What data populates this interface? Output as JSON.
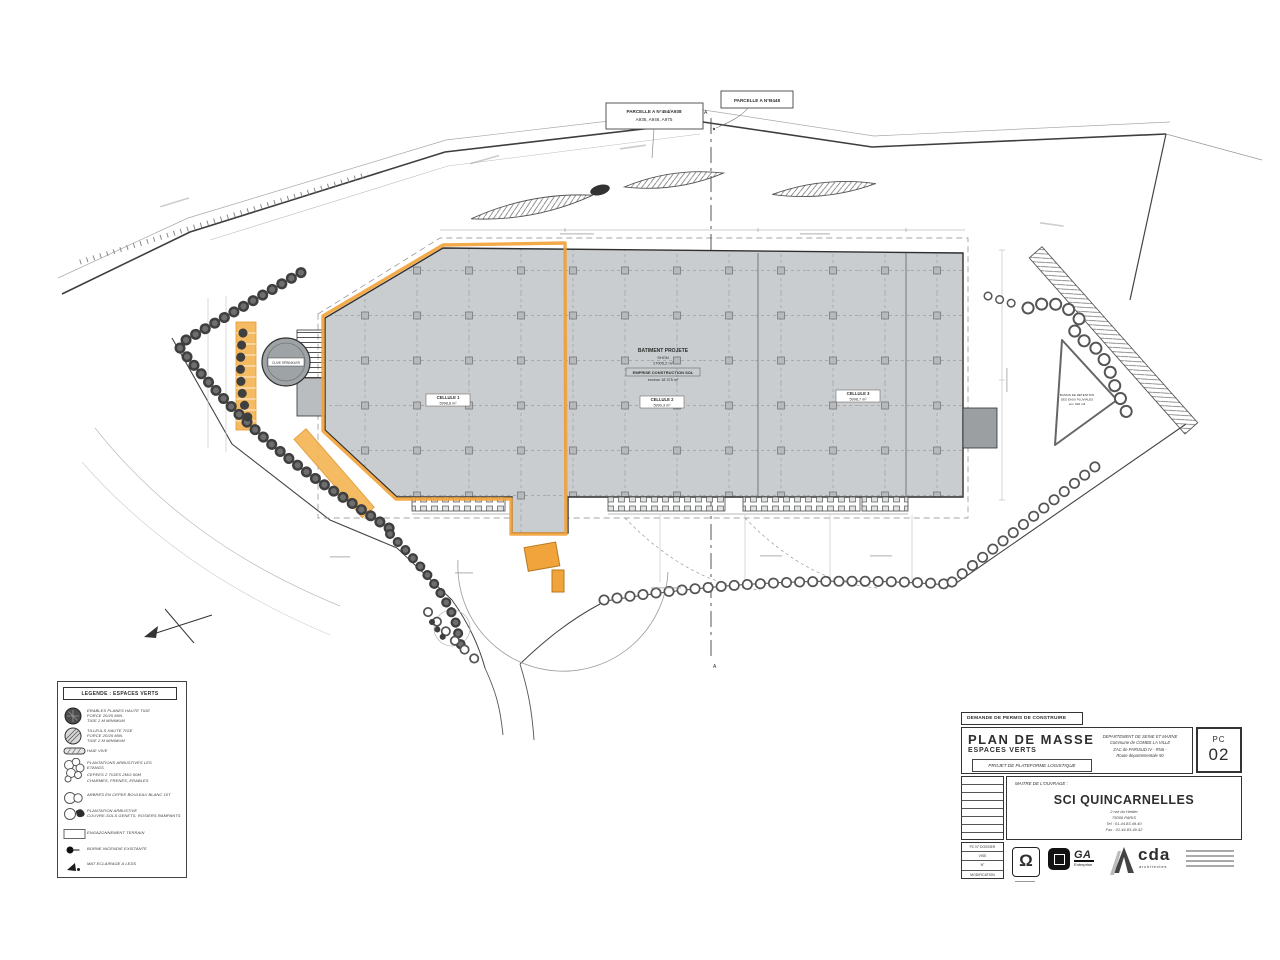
{
  "sheet": {
    "permit_banner": "DEMANDE DE PERMIS DE CONSTRUIRE",
    "title": "PLAN DE MASSE",
    "subtitle": "ESPACES VERTS",
    "project_box": "PROJET DE PLATEFORME LOGISTIQUE",
    "location_lines": [
      "DEPARTEMENT DE SEINE ET MARNE",
      "Commune de COMBS LA VILLE",
      "ZAC de PARISUD IV - RN6 -",
      "Route departementale 50"
    ],
    "sheet_code": "PC",
    "sheet_number": "02",
    "owner_label": "MAITRE DE L'OUVRAGE :",
    "owner_name": "SCI QUINCARNELLES",
    "owner_lines": [
      "2 rue du Helder",
      "75009 PARIS",
      "Tel : 01.44.83.49.40",
      "Fax : 01.44.83.49.42"
    ],
    "revision_rows": [
      "PC N° DOSSIER",
      "VISE",
      "N°",
      "MODIFICATION"
    ],
    "logos": {
      "omega": "Ω",
      "ga": "GA",
      "ga_sub": "Entreprise",
      "cda": "cda",
      "cda_sub": "architectes"
    }
  },
  "legend": {
    "title": "LEGENDE : ESPACES VERTS",
    "items": [
      {
        "lines": [
          "ERABLES PLANES HAUTE TIGE",
          "FORCE 20/25 MIN.",
          "TIGE 2 M MINIMUM"
        ]
      },
      {
        "lines": [
          "TILLEULS HAUTE TIGE",
          "FORCE 20/25 MIN.",
          "TIGE 2 M MINIMUM"
        ]
      },
      {
        "lines": [
          "HAIE VIVE"
        ]
      },
      {
        "lines": [
          "PLANTATIONS ARBUSTIVES LES",
          "ETANGS",
          "CEPEES 2 TIGES 2M/2.50M",
          "CHARMES, FRENES, ERABLES"
        ]
      },
      {
        "lines": [
          "ARBRES EN CEPEE BOULEAU BLANC 10T"
        ]
      },
      {
        "lines": [
          "PLANTATION ARBUSTIVE",
          "COUVRE-SOLS GENETS, ROSIERS RAMPANTS"
        ]
      },
      {
        "lines": [
          "ENGAZONNEMENT TERRAIN"
        ]
      },
      {
        "lines": [
          "BORNE INCENDIE EXISTANTE"
        ]
      },
      {
        "lines": [
          "MAT ECLAIRAGE A LEDS"
        ]
      }
    ]
  },
  "plan": {
    "parcel1": [
      "PARCELLE A N°454/A938",
      "A935, A946, A975"
    ],
    "parcel2": [
      "PARCELLE A N°B448"
    ],
    "building_lines": [
      "BATIMENT PROJETE",
      "SHON",
      "17005,2 m²",
      "EMPRISE CONSTRUCTION SOL",
      "environ 18 375 m²"
    ],
    "cells": [
      {
        "name": "CELLULE 1",
        "area": "5998,8 m²"
      },
      {
        "name": "CELLULE 2",
        "area": "5990,3 m²"
      },
      {
        "name": "CELLULE 3",
        "area": "5998,7 m²"
      }
    ],
    "tank_label": "CUVE SPRINKLER",
    "basin_lines": [
      "BASSIN DE RETENTION",
      "DES EAUX PLUVIALES",
      "env. 920 m3"
    ],
    "axis_marker": "A"
  },
  "colors": {
    "highlight_orange": "#f2a33c",
    "building_grey": "#c9cdcf",
    "ink": "#3c3c3c"
  }
}
